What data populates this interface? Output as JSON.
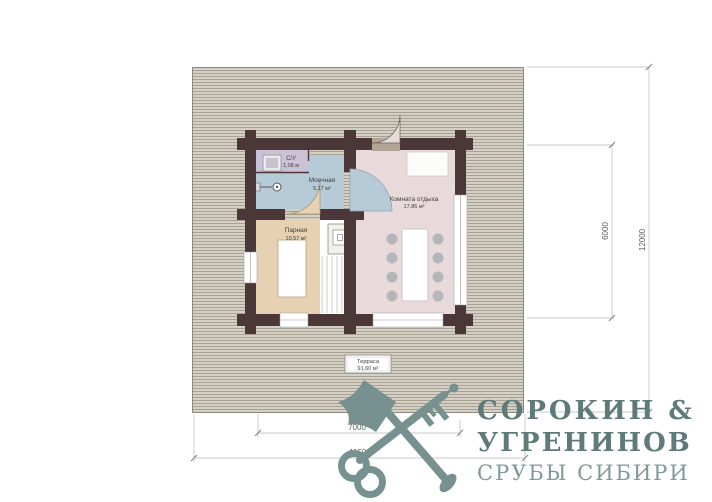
{
  "plan": {
    "rooms": [
      {
        "name": "С/У",
        "area": "1,08 м"
      },
      {
        "name": "Моечная",
        "area": "5,17 м²"
      },
      {
        "name": "Парная",
        "area": "10,57 м²"
      },
      {
        "name": "Комната отдыха",
        "area": "17,86 м²"
      },
      {
        "name": "Терраса",
        "area": "91,60 м²"
      }
    ],
    "dimensions": {
      "building_width": "7000",
      "terrace_width": "11500",
      "building_depth": "6000",
      "terrace_depth": "12000"
    }
  },
  "logo": {
    "name_line1": "СОРОКИН &",
    "name_line2": "УГРЕНИНОВ",
    "tagline": "СРУБЫ СИБИРИ"
  },
  "colors": {
    "wall": "#4b3738",
    "terrace_base": "#d5d0c5",
    "terrace_stripe": "#a8a193",
    "room_su": "#ccc2d8",
    "room_wash": "#b7cad7",
    "room_steam": "#e6d2b2",
    "room_lounge": "#e8d9db",
    "logo_mark": "#76918f",
    "logo_text": "#5e7a79"
  }
}
